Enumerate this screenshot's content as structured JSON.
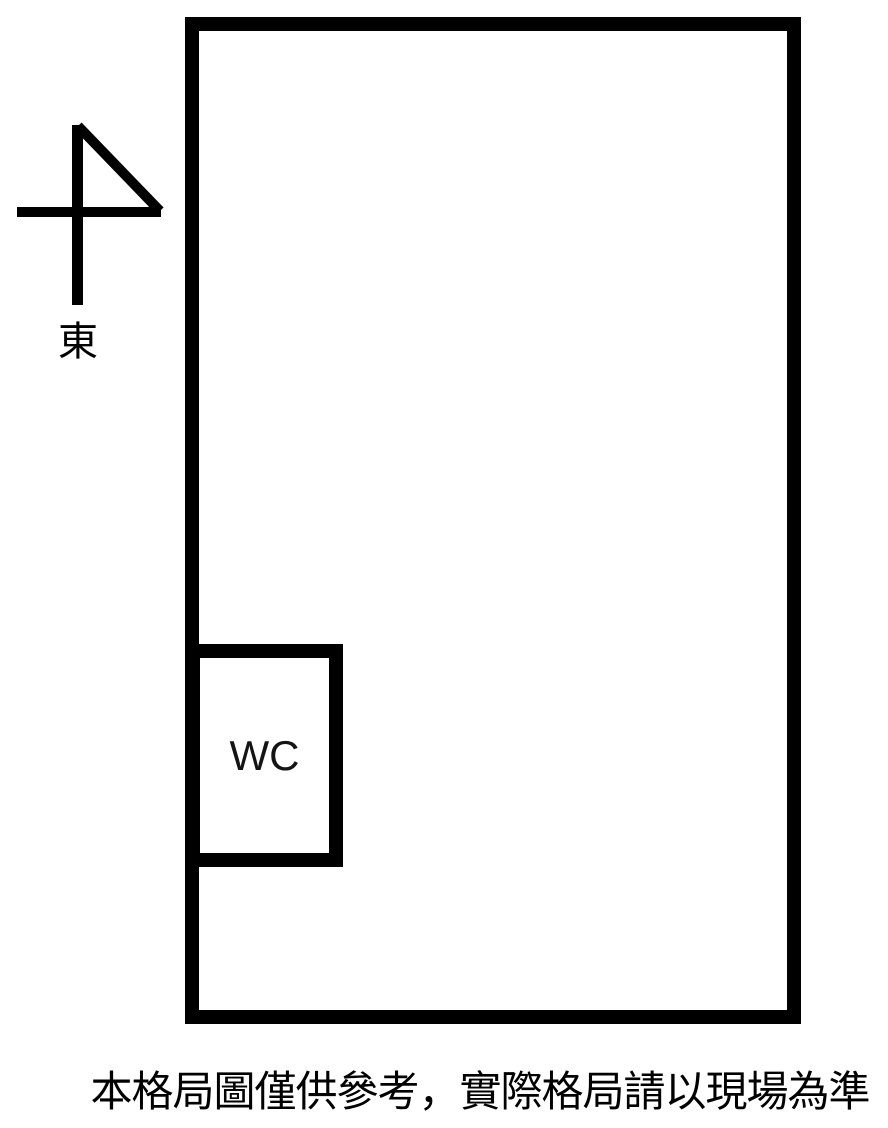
{
  "page": {
    "background_color": "#ffffff",
    "line_color": "#000000"
  },
  "floorplan": {
    "compass": {
      "icon": "compass-arrow",
      "direction_label": "東"
    },
    "rooms": [
      {
        "label": "WC"
      }
    ],
    "caption": "本格局圖僅供參考，實際格局請以現場為準"
  }
}
